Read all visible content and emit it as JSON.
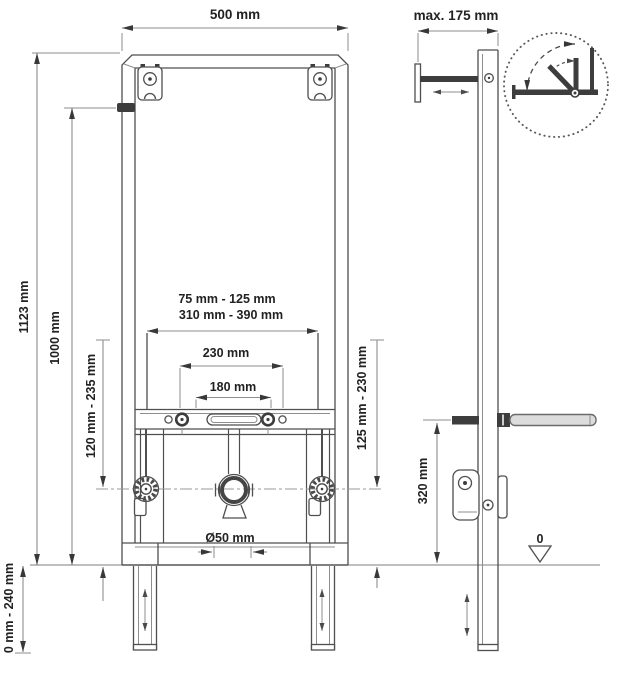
{
  "labels": {
    "front_width": "500 mm",
    "wall_distance": "max. 175 mm",
    "total_height": "1123 mm",
    "marking_height": "1000 mm",
    "left_outlet_height": "120 mm - 235 mm",
    "right_outlet_height": "125 mm - 230 mm",
    "foot_extension": "0 mm - 240 mm",
    "fixing_range_upper": "75 mm - 125 mm",
    "fixing_range_lower": "310 mm - 390 mm",
    "stud_spacing_outer": "230 mm",
    "stud_spacing_inner": "180 mm",
    "drain_diameter": "Ø50 mm",
    "support_rod_height": "320 mm",
    "floor_datum": "0"
  },
  "symbols": {
    "detail_circle": "swivel-range-detail",
    "datum_marker": "floor-datum-triangle",
    "adjustment_marker": "double-headed-arrow"
  },
  "colors": {
    "background": "#ffffff",
    "object_line": "#4f4f4f",
    "dimension_line": "#8e8e8e",
    "text": "#222222",
    "rod_fill": "#dcdcdc",
    "solid_part": "#3d3d3d"
  }
}
